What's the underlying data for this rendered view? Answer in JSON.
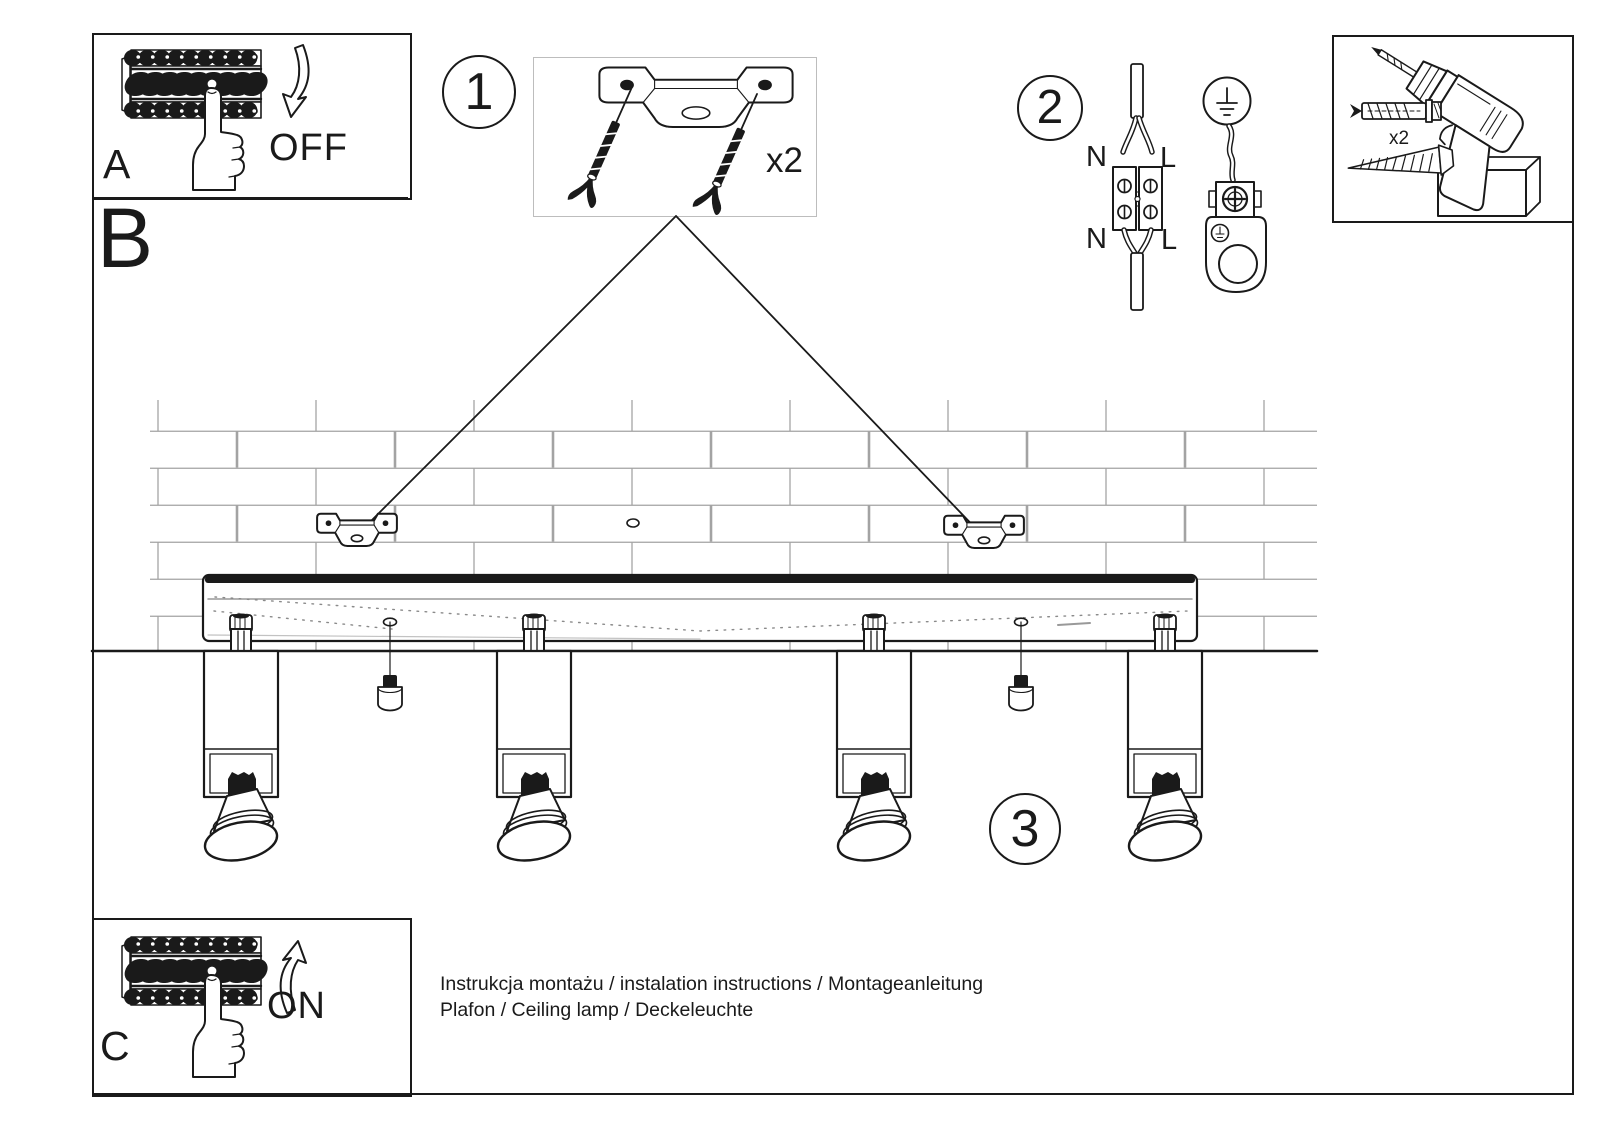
{
  "sections": {
    "a": {
      "label": "A",
      "state": "OFF"
    },
    "b": {
      "label": "B"
    },
    "c": {
      "label": "C",
      "state": "ON"
    }
  },
  "steps": {
    "one": "1",
    "two": "2",
    "three": "3"
  },
  "parts": {
    "mounting_bracket_qty": "x2",
    "wall_fixing_qty": "x2"
  },
  "wiring_labels": {
    "neutral_in": "N",
    "live_in": "L",
    "neutral_out": "N",
    "live_out": "L"
  },
  "footer": {
    "line1": "Instrukcja montażu / instalation instructions / Montageanleitung",
    "line2": "Plafon / Ceiling lamp / Deckeleuchte"
  },
  "colors": {
    "ink": "#1a1a1a",
    "brick_line": "#a3a3a3",
    "parts_box_border": "#bdbdbd"
  }
}
